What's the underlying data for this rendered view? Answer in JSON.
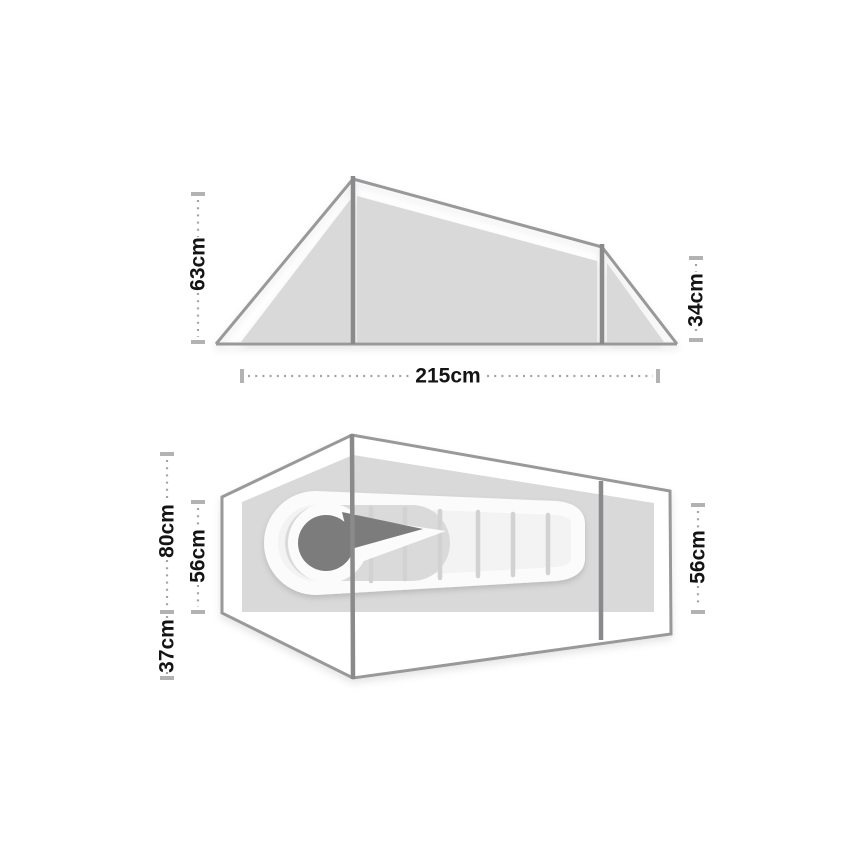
{
  "diagram": {
    "title": "Tent dimensions diagram",
    "side_view": {
      "labels": {
        "peak_height": "63cm",
        "rear_height": "34cm",
        "length": "215cm"
      }
    },
    "floor_plan": {
      "labels": {
        "max_inner_width": "80cm",
        "inner_width_left": "56cm",
        "inner_width_right": "56cm",
        "vestibule_depth": "37cm"
      }
    },
    "colors": {
      "fabric_fill": "#d9d9d9",
      "outline": "#99999b",
      "pole": "#8a8a8c",
      "tick": "#b2b2b2",
      "dot": "#a3a3a3",
      "text": "#141414",
      "bag_body": "#f3f3f3",
      "bag_halo": "#fbfbfb",
      "bag_baffle": "#d2d2d2",
      "hood_fabric": "#dadada",
      "hood_dark": "#7c7c7c"
    }
  }
}
